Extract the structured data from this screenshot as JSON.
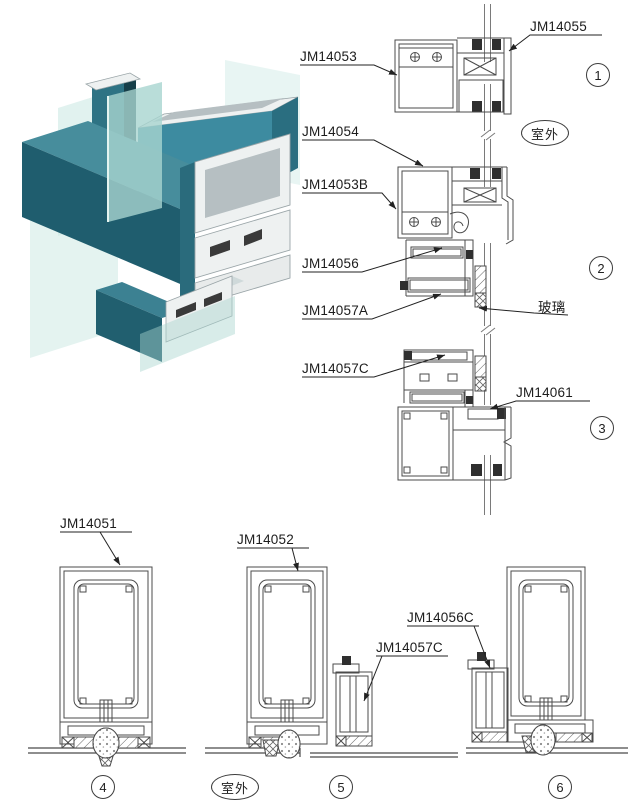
{
  "page": {
    "background": "#ffffff"
  },
  "colors": {
    "page_bg": "#ffffff",
    "line": "#4b4b4b",
    "teal_dark": "#1f5d6e",
    "teal_mid": "#3d8ba0",
    "teal_top": "#478d9c",
    "teal_deep": "#215f6f",
    "glass": "#a8d4cf",
    "glass_light": "#cde9e4",
    "aluminum": "#eef1f1",
    "aluminum_shade": "#b6bfc2"
  },
  "top_section": {
    "details": [
      {
        "marker": "1"
      },
      {
        "marker": "2"
      },
      {
        "marker": "3"
      }
    ],
    "callouts": {
      "jm14053": "JM14053",
      "jm14055": "JM14055",
      "jm14054": "JM14054",
      "jm14053b": "JM14053B",
      "jm14056": "JM14056",
      "jm14057a": "JM14057A",
      "jm14057c": "JM14057C",
      "jm14061": "JM14061"
    },
    "annotations": {
      "outdoor": "室外",
      "glass": "玻璃"
    }
  },
  "bottom_section": {
    "details": [
      {
        "marker": "4"
      },
      {
        "marker": "5"
      },
      {
        "marker": "6"
      }
    ],
    "callouts": {
      "jm14051": "JM14051",
      "jm14052": "JM14052",
      "jm14056c": "JM14056C",
      "jm14057c": "JM14057C"
    },
    "annotations": {
      "outdoor": "室外"
    }
  }
}
